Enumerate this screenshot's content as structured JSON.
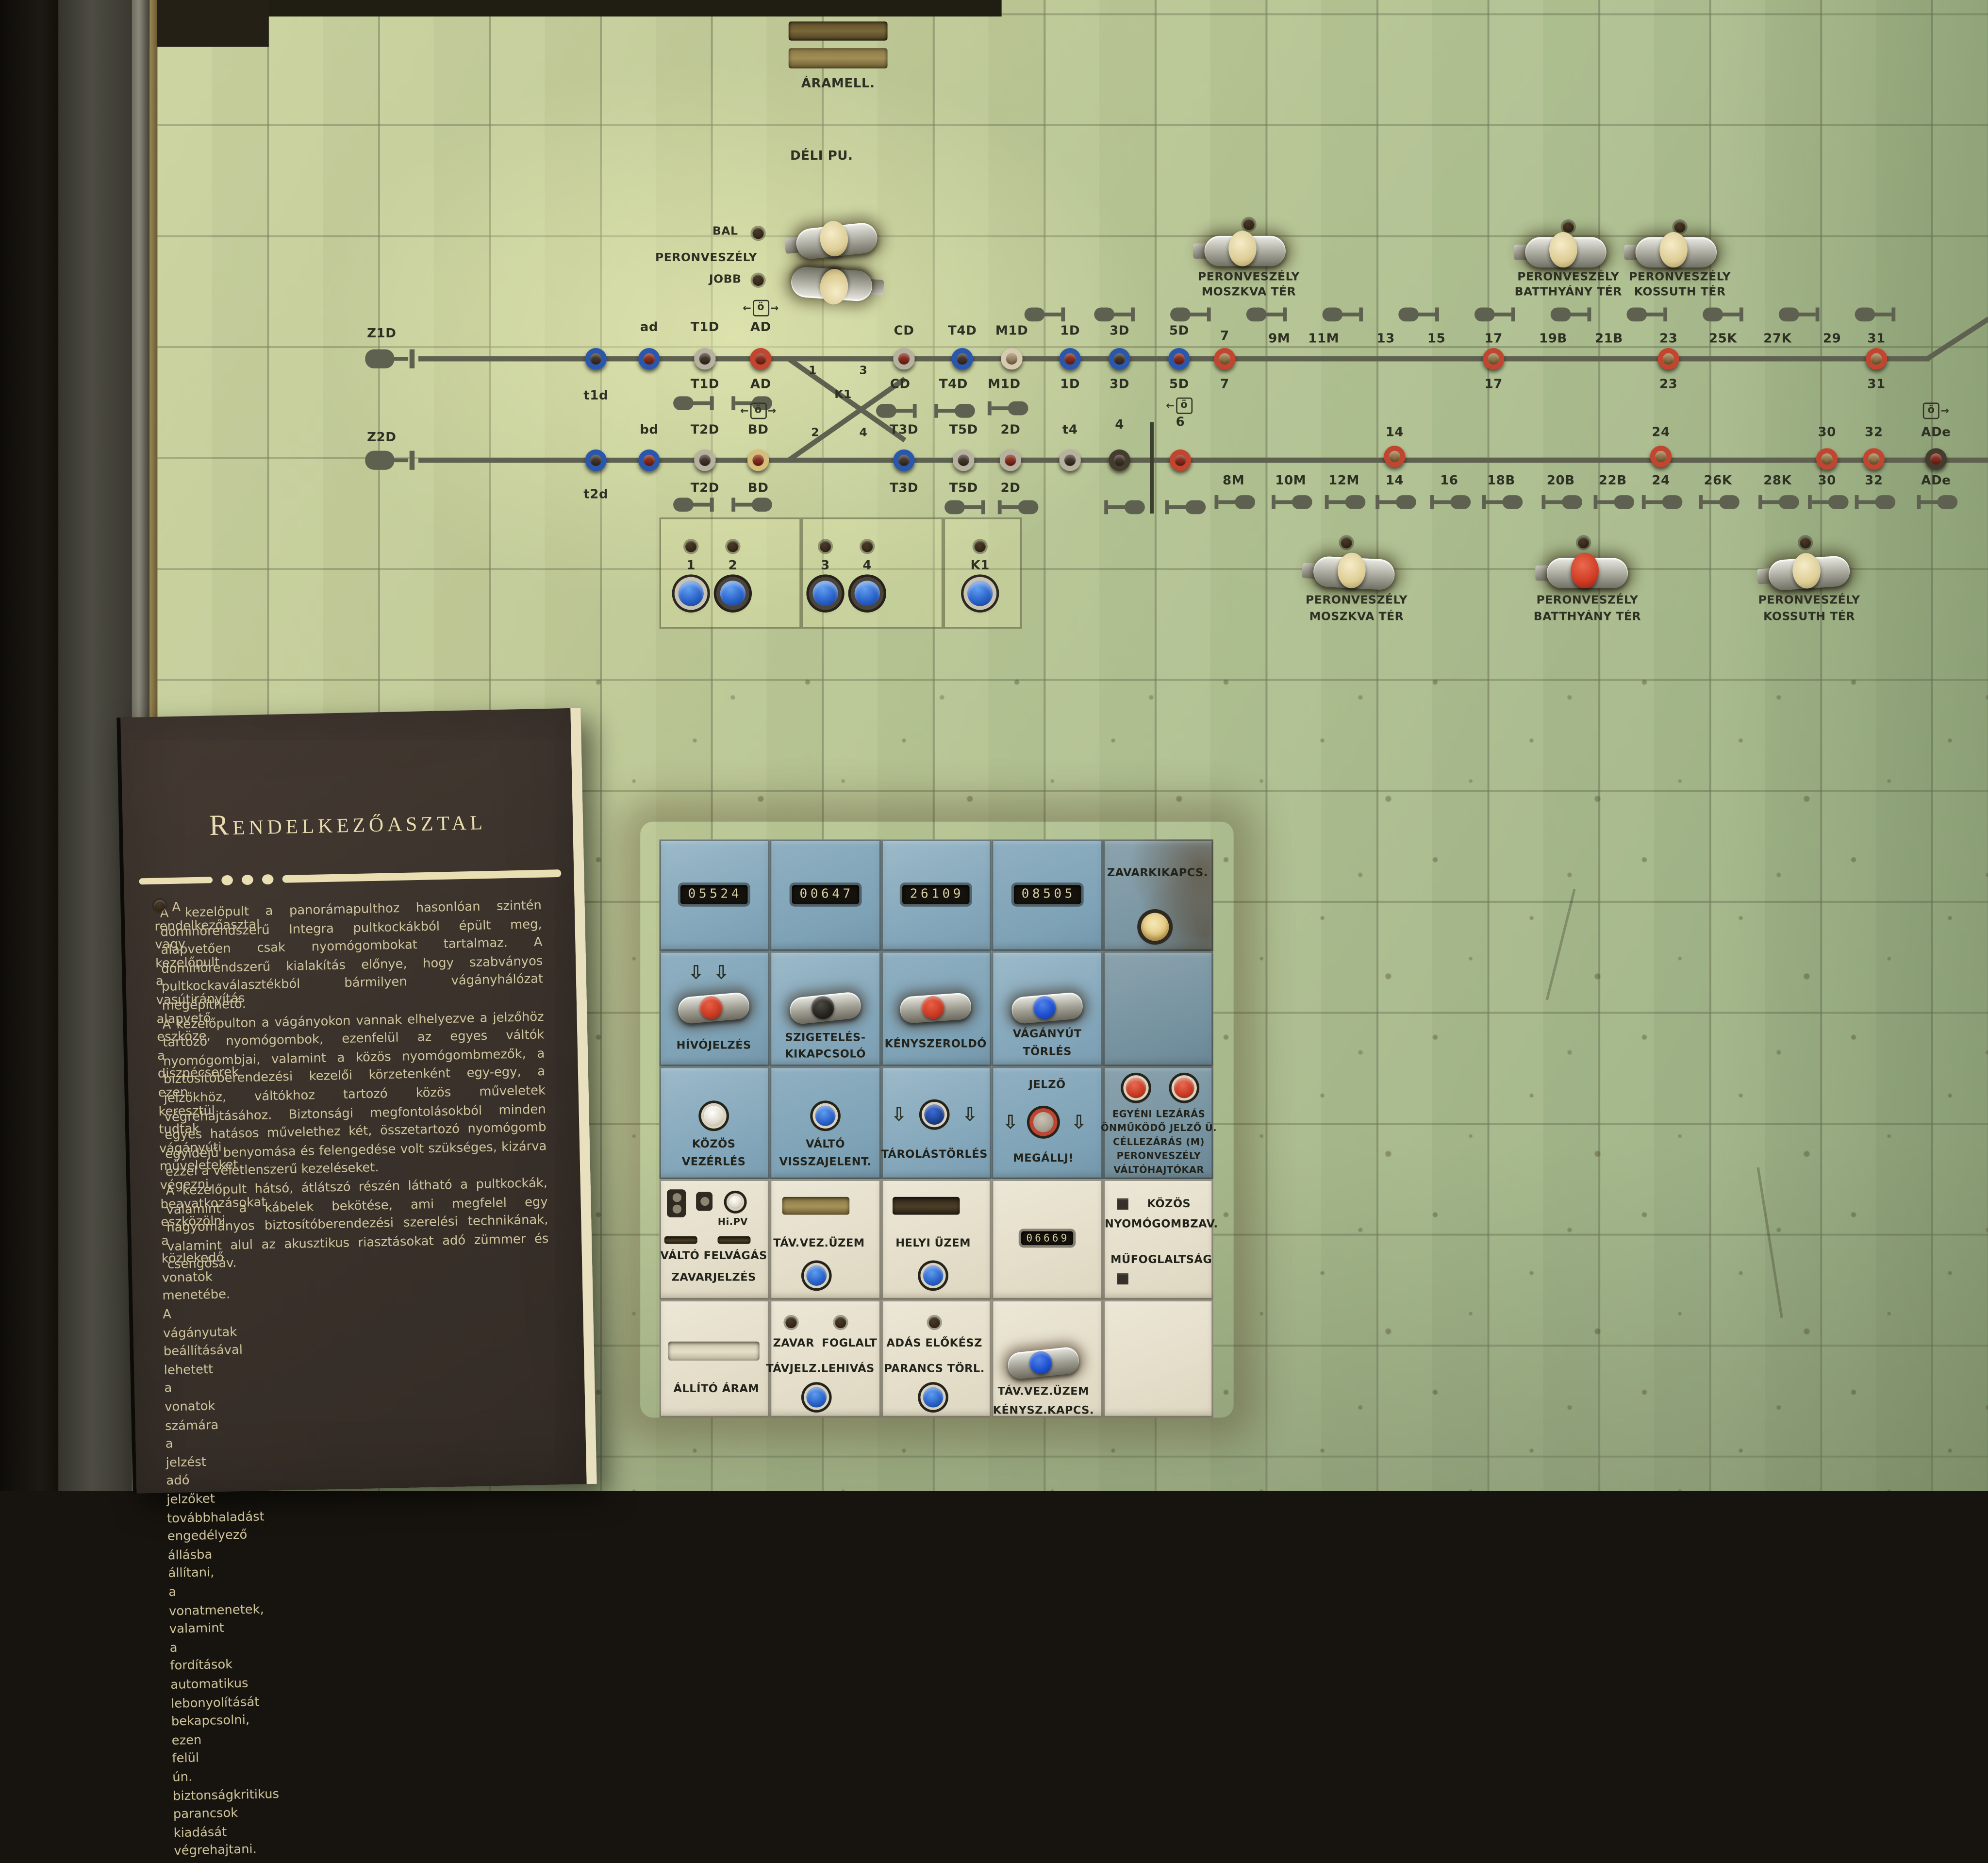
{
  "panel": {
    "aramell": "ÁRAMELL.",
    "deli_pu": "DÉLI PU.",
    "peron_left": {
      "bal": "BAL",
      "peron": "PERONVESZÉLY",
      "jobb": "JOBB"
    },
    "peron_top": [
      {
        "l1": "PERONVESZÉLY",
        "l2": "MOSZKVA TÉR"
      },
      {
        "l1": "PERONVESZÉLY",
        "l2": "BATTHYÁNY TÉR"
      },
      {
        "l1": "PERONVESZÉLY",
        "l2": "KOSSUTH TÉR"
      }
    ],
    "peron_mid": [
      {
        "l1": "PERONVESZÉLY",
        "l2": "MOSZKVA TÉR"
      },
      {
        "l1": "PERONVESZÉLY",
        "l2": "BATTHYÁNY TÉR"
      },
      {
        "l1": "PERONVESZÉLY",
        "l2": "KOSSUTH TÉR"
      }
    ]
  },
  "track1": {
    "start": "Z1D",
    "above": [
      "ad",
      "T1D",
      "AD",
      "CD",
      "T4D",
      "M1D",
      "1D",
      "3D",
      "5D",
      "7",
      "9M",
      "11M",
      "13",
      "15",
      "17",
      "19B",
      "21B",
      "23",
      "25K",
      "27K",
      "29",
      "31"
    ],
    "below": [
      "t1d",
      "T1D",
      "AD",
      "CD",
      "T4D",
      "M1D",
      "1D",
      "3D",
      "5D",
      "7",
      "17",
      "23",
      "31"
    ],
    "junction": {
      "one": "1",
      "three": "3",
      "k1": "K1"
    }
  },
  "track2": {
    "start": "Z2D",
    "above": [
      "bd",
      "T2D",
      "BD",
      "T3D",
      "T5D",
      "2D",
      "t4",
      "4",
      "6",
      "14",
      "24",
      "30",
      "32",
      "ADe"
    ],
    "below": [
      "t2d",
      "T2D",
      "BD",
      "T3D",
      "T5D",
      "2D",
      "8M",
      "10M",
      "12M",
      "14",
      "16",
      "18B",
      "20B",
      "22B",
      "24",
      "26K",
      "28K",
      "30",
      "32",
      "ADe"
    ],
    "junction": {
      "two": "2",
      "four": "4"
    }
  },
  "group_buttons": {
    "labels": [
      "1",
      "2",
      "3",
      "4",
      "K1"
    ]
  },
  "symbols": {
    "oe": "ö",
    "left": "←",
    "right": "→",
    "down": "⇩"
  },
  "placard": {
    "title": "Rendelkezőasztal",
    "p1": "A rendelkezőasztal vagy kezelőpult a vasútirányítás alapvető eszköze, a diszpécserek ezen keresztül tudtak vágányúti műveleteket végezni, beavatkozásokat eszközölni a közlekedő vonatok menetébe. A vágányutak beállításával lehetett a vonatok számára a jelzést adó jelzőket továbbhaladást engedélyező állásba állítani, a vonatmenetek, valamint a fordítások automatikus lebonyolítását bekapcsolni, ezen felül ún. biztonságkritikus parancsok kiadását végrehajtani.",
    "p2": "A kezelőpult a panorámapulthoz hasonlóan szintén dominórendszerű Integra pultkockákból épült meg, alapvetően csak nyomógombokat tartalmaz. A dominórendszerű kialakítás előnye, hogy szabványos pultkockaválasztékból bármilyen vágányhálózat megépíthető.",
    "p3": "A kezelőpulton a vágányokon vannak elhelyezve a jelzőhöz tartozó nyomógombok, ezenfelül az egyes váltók nyomógombjai, valamint a közös nyomógombmezők, a biztosítóberendezési kezelői körzetenként egy-egy, a jelzőkhöz, váltókhoz tartozó közös műveletek végrehajtásához. Biztonsági megfontolásokból minden egyes hatásos művelethez két, összetartozó nyomógomb egyidejű benyomása és felengedése volt szükséges, kizárva ezzel a véletlenszerű kezeléseket.",
    "p4": "A kezelőpult hátsó, átlátszó részén látható a pultkockák, valamint a kábelek bekötése, ami megfelel egy hagyományos biztosítóberendezési szerelési technikának, valamint alul az akusztikus riasztásokat adó zümmer és csengősáv."
  },
  "console": {
    "counters": [
      "05524",
      "00647",
      "26109",
      "08505"
    ],
    "zavarkikapcs": "ZAVARKIKAPCS.",
    "hivojelzes": "HÍVÓJELZÉS",
    "szigeteles_l1": "SZIGETELÉS-",
    "szigeteles_l2": "KIKAPCSOLÓ",
    "kenyszeroldo": "KÉNYSZEROLDÓ",
    "vaganyut_l1": "VÁGÁNYÚT",
    "vaganyut_l2": "TÖRLÉS",
    "kozos_l1": "KÖZÖS",
    "kozos_l2": "VEZÉRLÉS",
    "valto_l1": "VÁLTÓ",
    "valto_l2": "VISSZAJELENT.",
    "tarolastorles": "TÁROLÁSTÖRLÉS",
    "jelzo": "JELZŐ",
    "megallj": "MEGÁLLJ!",
    "egyeni": [
      "EGYÉNI LEZÁRÁS",
      "ÖNMŰKÖDŐ JELZŐ Ü.",
      "CÉLLEZÁRÁS (M)",
      "PERONVESZÉLY",
      "VÁLTÓHAJTÓKAR"
    ],
    "hipv": "Hi.PV",
    "valto_felvagas": "VÁLTÓ FELVÁGÁS",
    "zavarjelzes": "ZAVARJELZÉS",
    "tav_vez_uzem": "TÁV.VEZ.ÜZEM",
    "helyi_uzem": "HELYI ÜZEM",
    "counter5": "06669",
    "kozos_nyomo_l1": "KÖZÖS",
    "kozos_nyomo_l2": "NYOMÓGOMBZAV.",
    "mufoglaltsag": "MŰFOGLALTSÁG",
    "allito_aram": "ÁLLÍTÓ ÁRAM",
    "zavar": "ZAVAR",
    "foglalt": "FOGLALT",
    "tavjelz": "TÁVJELZ.LEHIVÁS",
    "adas_elokesz": "ADÁS ELŐKÉSZ",
    "parancs_torl": "PARANCS TÖRL.",
    "tvu_l1": "TÁV.VEZ.ÜZEM",
    "tvu_l2": "KÉNYSZ.KAPCS."
  }
}
